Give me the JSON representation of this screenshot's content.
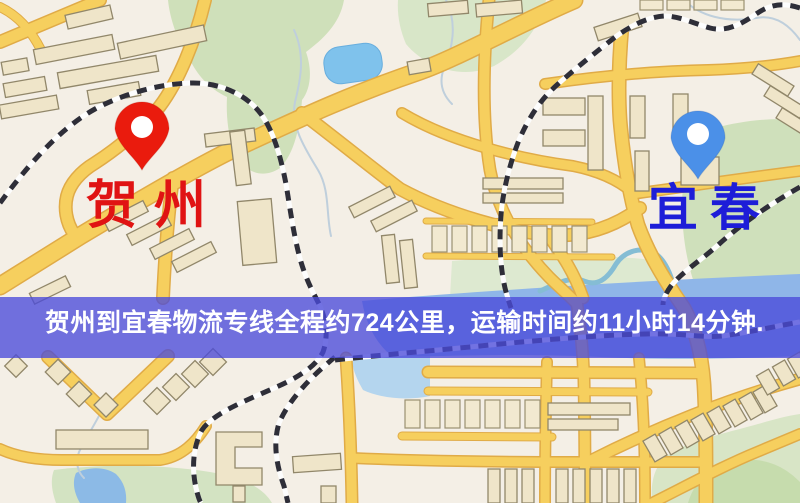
{
  "route": {
    "origin": "贺州",
    "destination": "宜春",
    "distance_text": "约724公里",
    "duration_text": "约11小时14分钟"
  },
  "banner": {
    "text": "贺州到宜春物流专线全程约724公里，运输时间约11小时14分钟.",
    "bg_color": "#4a4ada",
    "text_color": "#ffffff"
  },
  "origin_marker": {
    "label": "贺州",
    "pin_color": "#ea1b0d",
    "label_color": "#e01313"
  },
  "destination_marker": {
    "label": "宜春",
    "pin_color": "#4b90e8",
    "label_color": "#1d1dd8"
  },
  "palette": {
    "land": "#f4efe6",
    "road": "#f6cf5e",
    "road_casing": "#e0ab47",
    "park": "#cfe0ba",
    "water": "#8fb6e8",
    "lake": "#7fc2ec",
    "building": "#efe5c9",
    "railway": "#2e2e38"
  }
}
